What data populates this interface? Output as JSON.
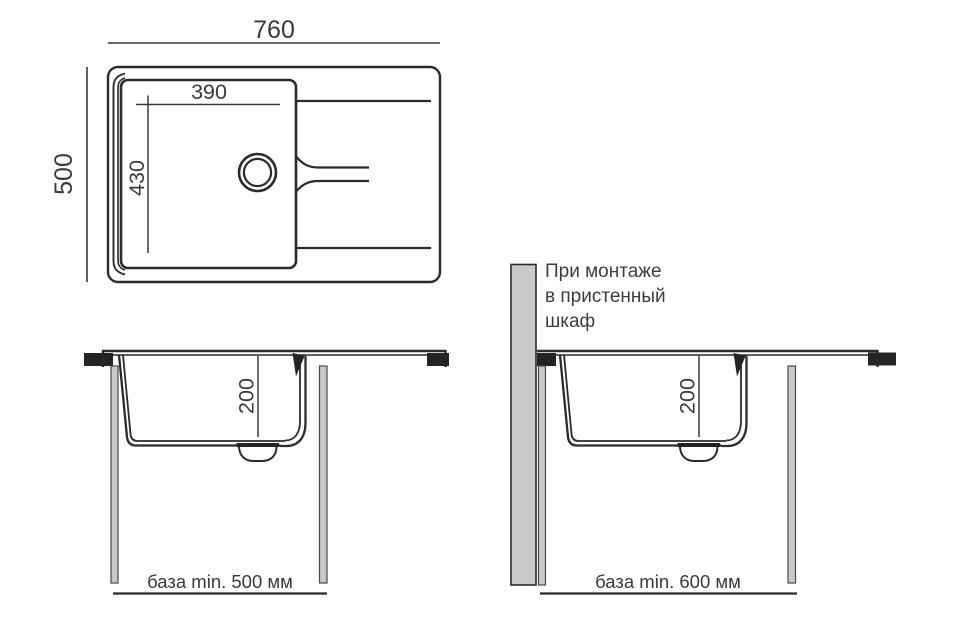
{
  "drawing_title": "sink-installation-diagram",
  "colors": {
    "line": "#2b2b2b",
    "text": "#3a3a3a",
    "cabinet_panel_gray": "#c9c9c9",
    "countertop_black": "#242424",
    "background": "#ffffff"
  },
  "top_view": {
    "overall_width_mm": "760",
    "overall_depth_mm": "500",
    "bowl_width_mm": "390",
    "bowl_depth_mm": "430"
  },
  "left_section": {
    "bowl_depth_mm": "200",
    "base_note": "база min. 500 мм"
  },
  "right_section": {
    "bowl_depth_mm": "200",
    "base_note": "база min. 600 мм",
    "wall_note_lines": [
      "При монтаже",
      "в пристенный",
      "шкаф"
    ]
  }
}
